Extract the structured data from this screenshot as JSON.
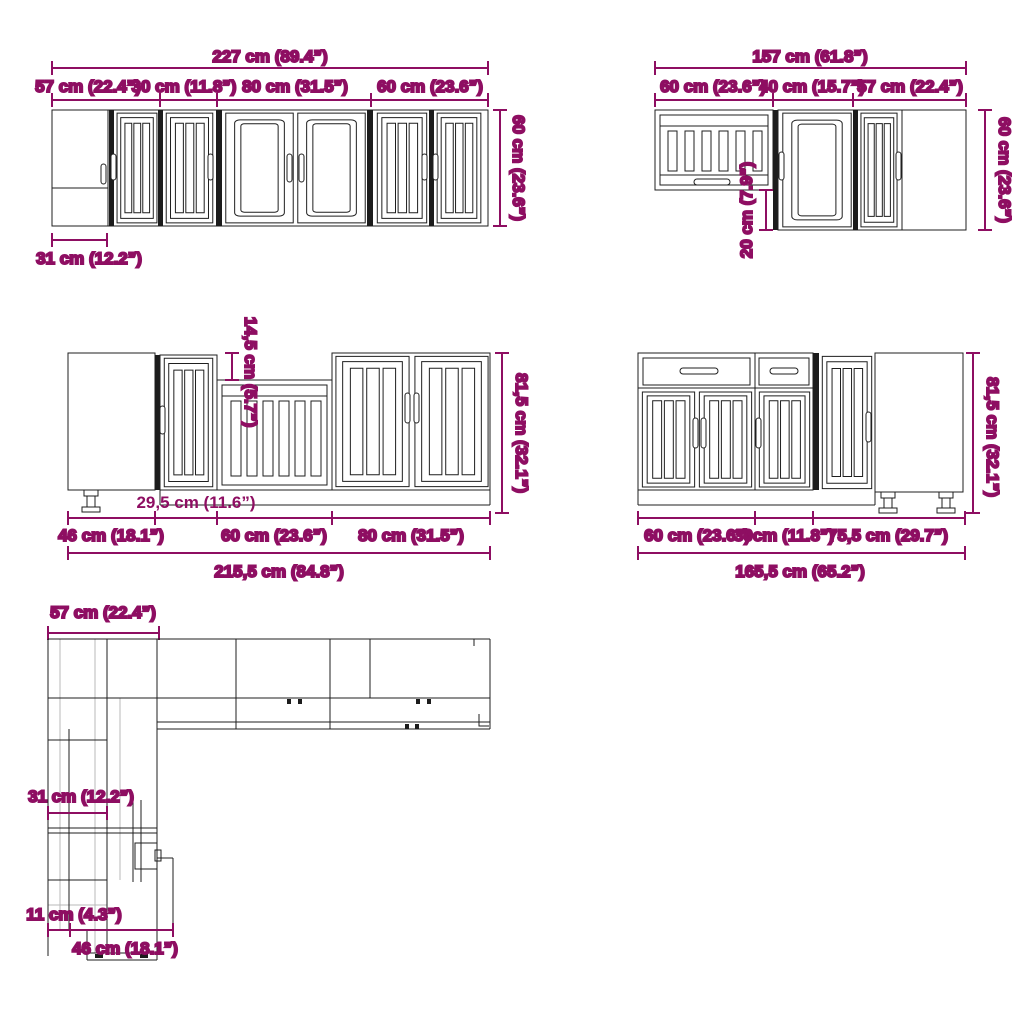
{
  "colors": {
    "dimension_accent": "#8E0E62",
    "drawing_line": "#1f1f1f",
    "construction_line": "#b8b8b8",
    "background": "#ffffff"
  },
  "wall_run_left": {
    "total_width": "227 cm (89.4”)",
    "segment_widths": [
      "57 cm (22.4”)",
      "30 cm (11.8”)",
      "80 cm (31.5”)",
      "60 cm (23.6”)"
    ],
    "height": "60 cm (23.6”)",
    "corner_depth": "31 cm (12.2”)"
  },
  "wall_run_right": {
    "total_width": "157 cm (61.8”)",
    "segment_widths": [
      "60 cm (23.6”)",
      "40 cm (15.7”)",
      "57 cm (22.4”)"
    ],
    "height": "60 cm (23.6”)",
    "bottom_offset": "20 cm (7.9”)"
  },
  "base_run_left": {
    "total_width": "215,5 cm (84.8”)",
    "segment_widths": [
      "46 cm (18.1”)",
      "60 cm (23.6”)",
      "80 cm (31.5”)"
    ],
    "sink_unit_width": "29,5 cm (11.6”)",
    "worktop_step": "14,5 cm (5.7”)",
    "height": "81,5 cm (32.1”)"
  },
  "base_run_right": {
    "total_width": "165,5 cm (65.2”)",
    "segment_widths": [
      "60 cm (23.6”)",
      "30cm (11.8”)",
      "75,5 cm (29.7”)"
    ],
    "height": "81,5 cm (32.1”)"
  },
  "plan_view": {
    "wall_width": "57 cm (22.4”)",
    "cabinet_depth": "31 cm (12.2”)",
    "side_gap": "11 cm (4.3”)",
    "unit_width": "46 cm (18.1”)"
  }
}
